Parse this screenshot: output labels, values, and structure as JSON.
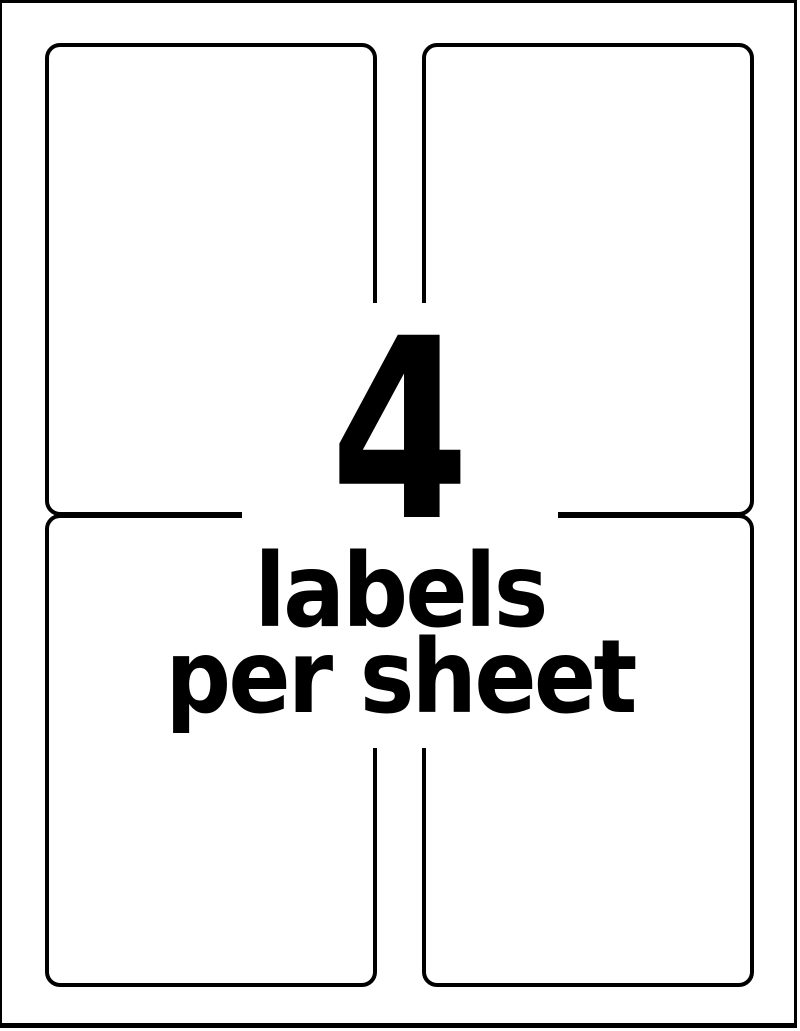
{
  "theme": {
    "ink": "#000000",
    "bg": "#ffffff"
  },
  "sheet": {
    "labels_per_sheet": 4,
    "rows": 2,
    "columns": 2
  },
  "overlay": {
    "count": "4",
    "line1": "labels",
    "line2": "per sheet"
  }
}
